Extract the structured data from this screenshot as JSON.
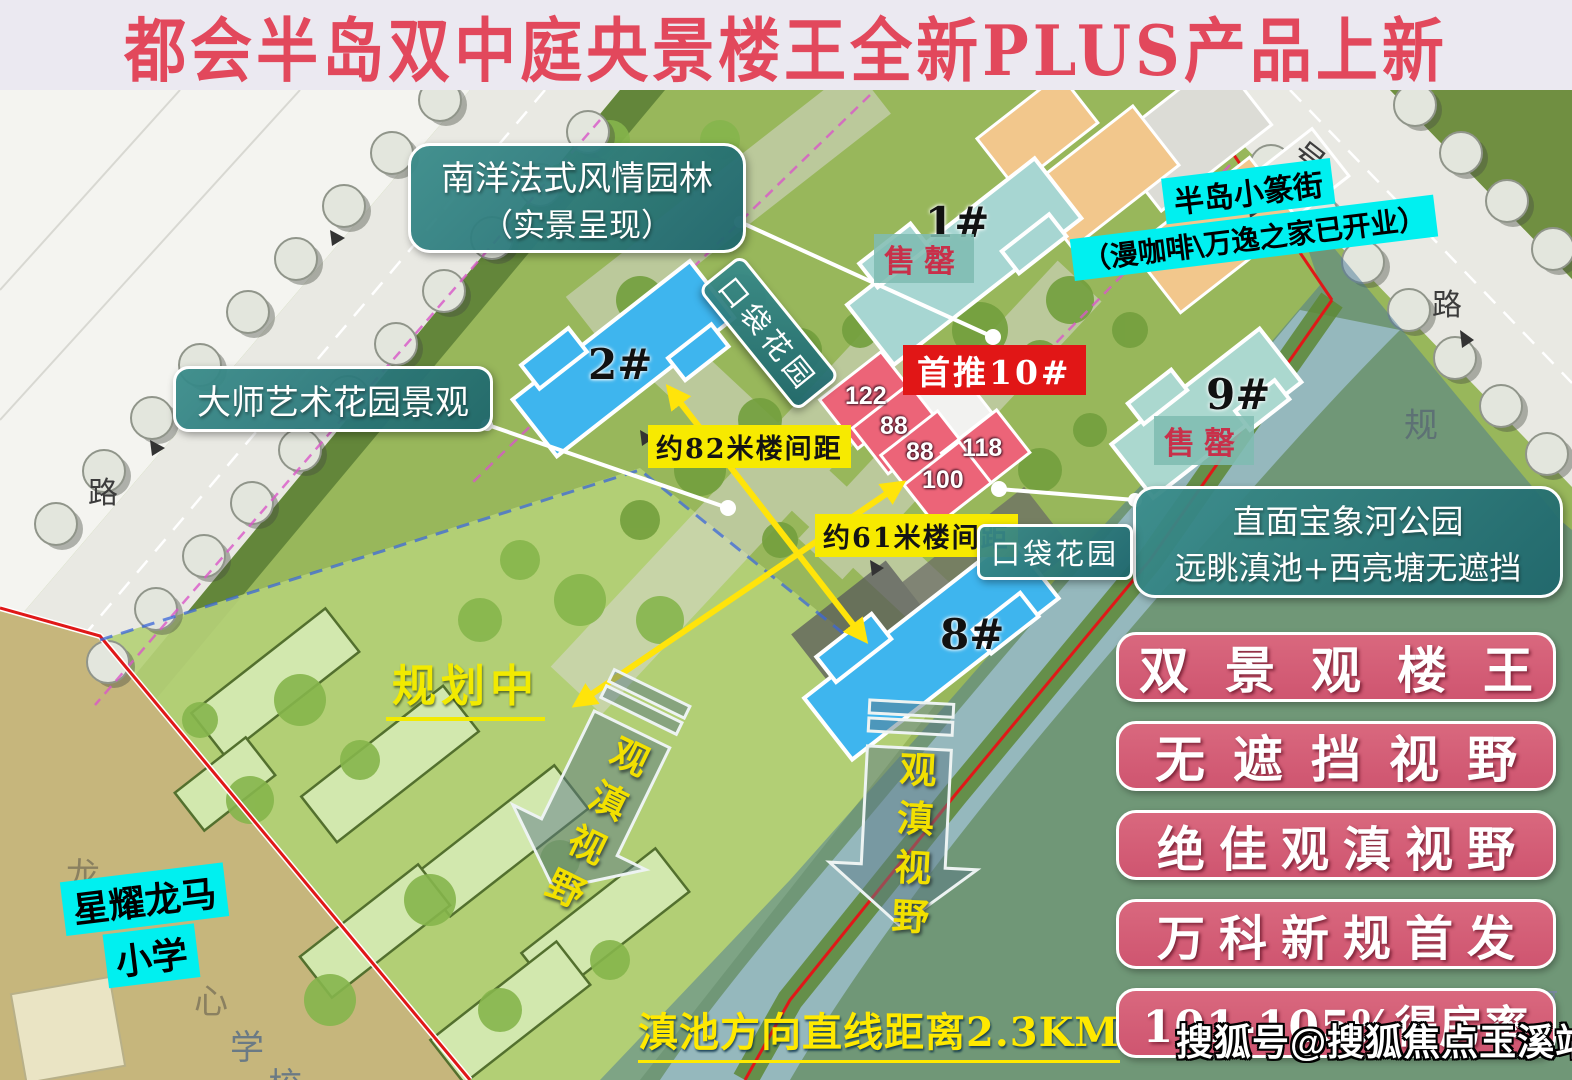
{
  "title": "都会半岛双中庭央景楼王全新PLUS产品上新",
  "callouts": {
    "garden_style": {
      "line1": "南洋法式风情园林",
      "line2": "（实景呈现）"
    },
    "street": {
      "line1": "半岛小篆街",
      "line2": "（漫咖啡\\万逸之家已开业）"
    },
    "pocket_garden_1": "口袋花园",
    "pocket_garden_2": "口袋花园",
    "first_launch": "首推10#",
    "master_garden": "大师艺术花园景观",
    "spacing_82": "约82米楼间距",
    "spacing_61": "约61米楼间距",
    "river_park": {
      "line1": "直面宝象河公园",
      "line2": "远眺滇池+西亮塘无遮挡"
    },
    "planning": "规划中",
    "view_corridor_1": "观滇视野",
    "view_corridor_2": "观滇视野",
    "school": {
      "line1": "星耀龙马",
      "line2": "小学"
    },
    "distance": "滇池方向直线距离2.3KM"
  },
  "buildings": {
    "b1": {
      "label": "1#",
      "status": "售罄"
    },
    "b2": {
      "label": "2#"
    },
    "b8": {
      "label": "8#"
    },
    "b9": {
      "label": "9#",
      "status": "售罄"
    },
    "b10_units": [
      "122",
      "88",
      "88",
      "118",
      "100"
    ]
  },
  "selling_points": [
    "双景观楼王",
    "无遮挡视野",
    "绝佳观滇视野",
    "万科新规首发",
    "101-105%得房率"
  ],
  "watermark": "搜狐号@搜狐焦点玉溪站",
  "map_labels": {
    "road_left": "路",
    "road_right": "路",
    "road_no": "号",
    "plan_char": "规",
    "school_chars": [
      "龙",
      "心",
      "学",
      "校"
    ],
    "river_chars": [
      "象",
      "河"
    ]
  },
  "colors": {
    "title_red": "#e2485c",
    "teal_box": "#2a7d80",
    "cyan_hl": "#00f0f0",
    "pill_pink": "#d25b72",
    "building_blue": "#3eb5ee",
    "building_pink": "#ec6478",
    "building_sold_teal": "#a7d6d2",
    "highlight_yellow": "#f7ea00",
    "first_red": "#e11616"
  }
}
